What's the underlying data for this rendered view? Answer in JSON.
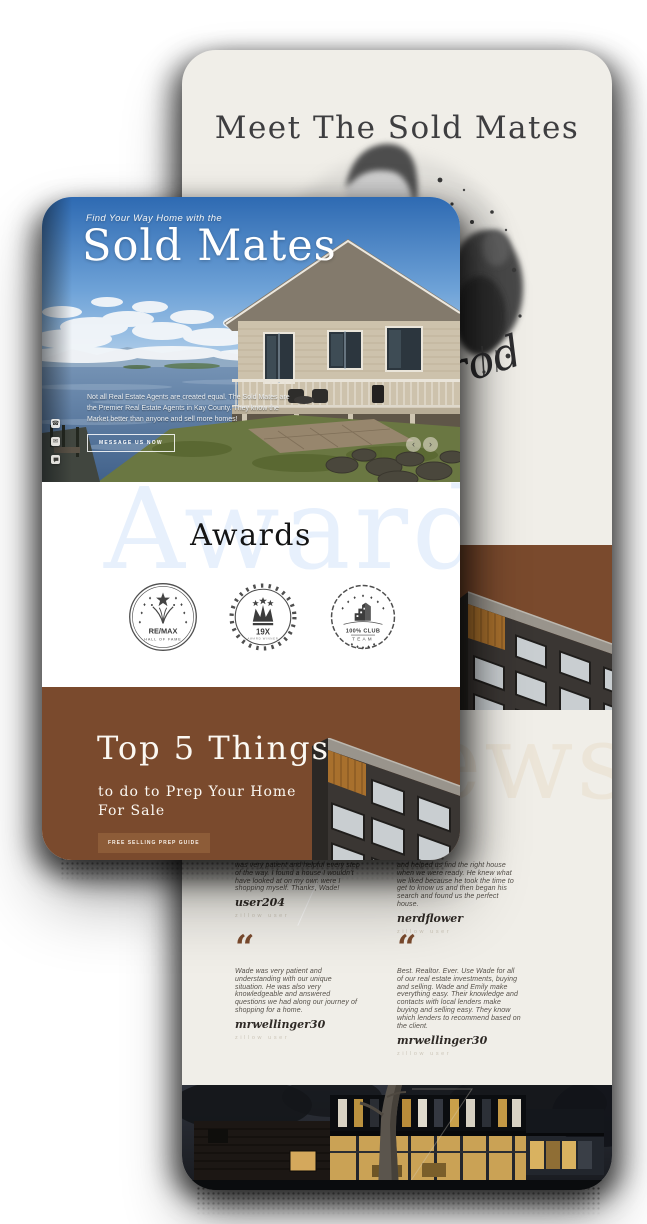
{
  "ui": {
    "icons": {
      "quote_glyph": "“",
      "carousel_prev": "‹",
      "carousel_next": "›",
      "phone_glyph": "☎",
      "mail_glyph": "✉"
    },
    "colors": {
      "brand_brown": "#7a4a2d",
      "button_brown": "#8d5c38",
      "cream": "#f0eee8",
      "heading_dark": "#3e3e40",
      "awards_watermark_blue": "#e7f0fc",
      "reviews_watermark_beige": "#ece5d8"
    }
  },
  "back_phone": {
    "meet": {
      "title": "Meet The Sold Mates",
      "signature_visible": "rod"
    },
    "reviews": {
      "watermark": "Reviews",
      "testimonials": [
        {
          "quote": "was very patient and helpful every step of the way. I found a house I wouldn't have looked at on my own were I shopping myself. Thanks, Wade!",
          "name": "user204",
          "source": "zillow user"
        },
        {
          "quote": "and helped us find the right house when we were ready. He knew what we liked because he took the time to get to know us and then began his search and found us the perfect house.",
          "name": "nerdflower",
          "source": "zillow user"
        },
        {
          "quote": "Wade was very patient and understanding with our unique situation. He was also very knowledgeable and answered questions we had along our journey of shopping for a home.",
          "name": "mrwellinger30",
          "source": "zillow user"
        },
        {
          "quote": "Best. Realtor. Ever. Use Wade for all of our real estate investments, buying and selling. Wade and Emily make everything easy. Their knowledge and contacts with local lenders make buying and selling easy. They know which lenders to recommend based on the client.",
          "name": "mrwellinger30",
          "source": "zillow user"
        }
      ]
    }
  },
  "front_phone": {
    "hero": {
      "eyebrow": "Find Your Way Home with the",
      "title": "Sold Mates",
      "description": "Not all Real Estate Agents are created equal. The Sold Mates are the Premier Real Estate Agents in Kay County. They know the Market better than anyone and sell more homes!",
      "cta": "MESSAGE US NOW",
      "contact_links": [
        "phone",
        "email",
        "chat"
      ]
    },
    "awards": {
      "watermark": "Awards",
      "title": "Awards",
      "badges": [
        {
          "name": "remax-hall-of-fame",
          "line1": "RE/MAX",
          "line2": "HALL OF FAME"
        },
        {
          "name": "19x-award",
          "line1": "19X",
          "line2": "AWARD WINNER"
        },
        {
          "name": "100-percent-club-team",
          "line1": "100% CLUB",
          "line2": "TEAM"
        }
      ]
    },
    "top5": {
      "title": "Top 5 Things",
      "subtitle_line1": "to do to Prep Your Home",
      "subtitle_line2": "For Sale",
      "cta": "FREE SELLING PREP GUIDE"
    }
  }
}
